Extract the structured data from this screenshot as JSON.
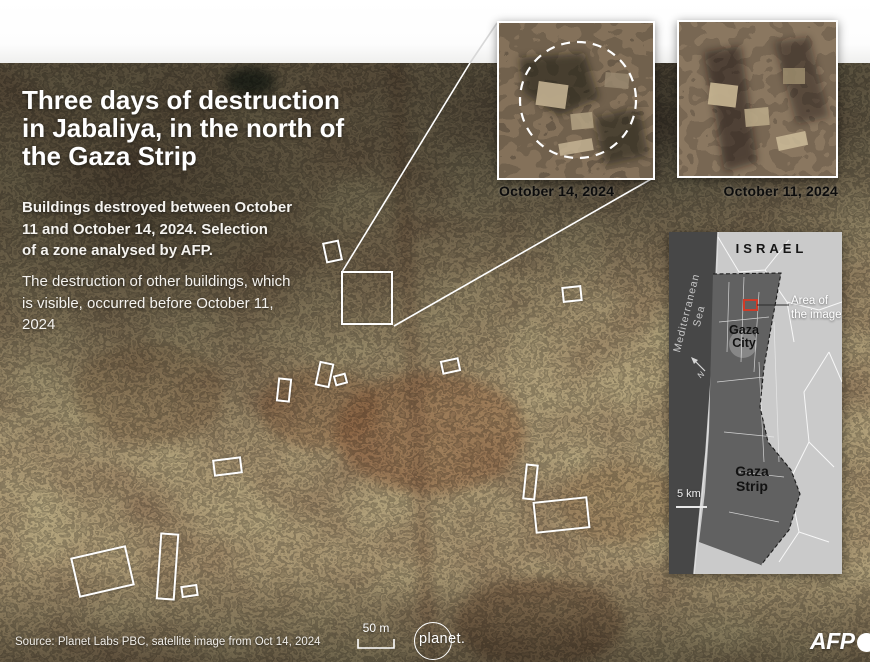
{
  "header": {
    "title": "Three days of destruction\nin Jabaliya, in the north of\nthe Gaza Strip",
    "paragraph_bold": "Buildings destroyed between October\n11 and October 14, 2024. Selection\nof a zone analysed by AFP.",
    "paragraph_regular": "The destruction of other buildings, which\nis visible, occurred before October 11,\n2024"
  },
  "insets": {
    "left": {
      "label": "October 14, 2024"
    },
    "right": {
      "label": "October 11, 2024"
    }
  },
  "minimap": {
    "country": "ISRAEL",
    "sea": "Mediterranean\nSea",
    "city": "Gaza\nCity",
    "region": "Gaza\nStrip",
    "area_callout": "Area of\nthe image",
    "scale": "5 km",
    "marker_color": "#cf3b28"
  },
  "footer": {
    "source": "Source: Planet Labs PBC, satellite image from Oct 14, 2024",
    "scalebar": "50 m",
    "planet_logo": "planet.",
    "afp_logo": "AFP"
  },
  "annotations": {
    "outline_color": "#ffffff",
    "boxes": [
      {
        "x": 324,
        "y": 241,
        "w": 17,
        "h": 21,
        "rot": -12,
        "sw": 2
      },
      {
        "x": 341,
        "y": 271,
        "w": 52,
        "h": 54,
        "rot": 0,
        "sw": 2.5
      },
      {
        "x": 562,
        "y": 286,
        "w": 20,
        "h": 16,
        "rot": -6,
        "sw": 2
      },
      {
        "x": 277,
        "y": 378,
        "w": 14,
        "h": 24,
        "rot": 6,
        "sw": 2
      },
      {
        "x": 317,
        "y": 362,
        "w": 15,
        "h": 25,
        "rot": 12,
        "sw": 2
      },
      {
        "x": 334,
        "y": 374,
        "w": 13,
        "h": 11,
        "rot": -15,
        "sw": 2
      },
      {
        "x": 441,
        "y": 359,
        "w": 19,
        "h": 14,
        "rot": -12,
        "sw": 2
      },
      {
        "x": 213,
        "y": 458,
        "w": 29,
        "h": 17,
        "rot": -7,
        "sw": 2
      },
      {
        "x": 524,
        "y": 464,
        "w": 13,
        "h": 36,
        "rot": 6,
        "sw": 2
      },
      {
        "x": 534,
        "y": 499,
        "w": 55,
        "h": 32,
        "rot": -6,
        "sw": 2
      },
      {
        "x": 74,
        "y": 551,
        "w": 57,
        "h": 41,
        "rot": -13,
        "sw": 2
      },
      {
        "x": 158,
        "y": 533,
        "w": 19,
        "h": 67,
        "rot": 4,
        "sw": 2
      },
      {
        "x": 181,
        "y": 585,
        "w": 17,
        "h": 12,
        "rot": -8,
        "sw": 2
      }
    ],
    "callout_lines": [
      {
        "x1": 342,
        "y1": 272,
        "x2": 470,
        "y2": 63,
        "color": "#ffffff"
      },
      {
        "x1": 470,
        "y1": 63,
        "x2": 497,
        "y2": 23,
        "color": "#d8d8d8"
      },
      {
        "x1": 394,
        "y1": 326,
        "x2": 653,
        "y2": 178,
        "color": "#ffffff"
      }
    ]
  }
}
